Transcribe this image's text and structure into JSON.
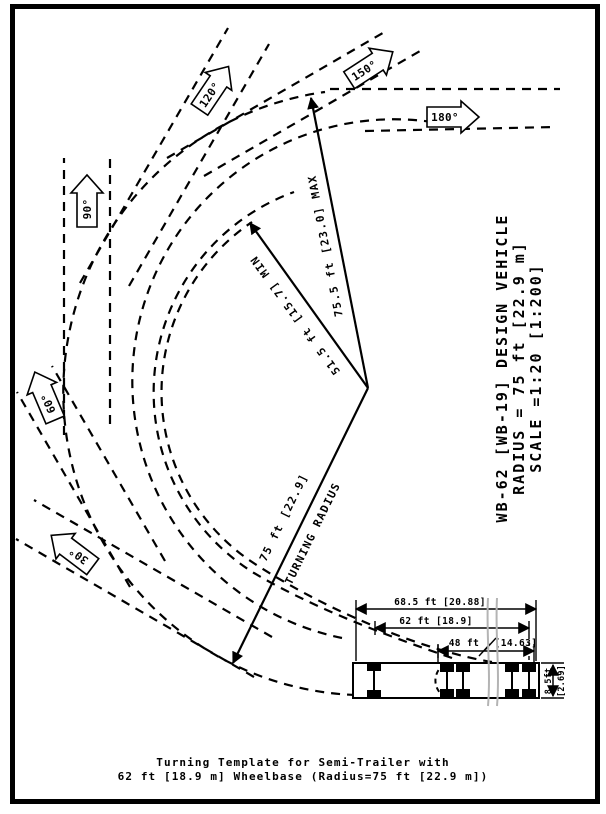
{
  "figure": {
    "caption": {
      "line1": "Turning Template for Semi-Trailer with",
      "line2": "62 ft [18.9 m] Wheelbase (Radius=75 ft [22.9 m])"
    },
    "title_block": {
      "line1": "WB-62 [WB-19] DESIGN VEHICLE",
      "line2": "RADIUS = 75 ft [22.9 m]",
      "line3": "SCALE =1:20 [1:200]"
    },
    "radius_annotations": {
      "turning_radius_value": "75 ft [22.9]",
      "turning_radius_label": "TURNING RADIUS",
      "min_radius": "51.5 ft [15.7] MIN",
      "max_radius": "75.5 ft [23.0] MAX"
    },
    "angle_markers": [
      {
        "label": "30°"
      },
      {
        "label": "60°"
      },
      {
        "label": "90°"
      },
      {
        "label": "120°"
      },
      {
        "label": "150°"
      },
      {
        "label": "180°"
      }
    ],
    "vehicle_dimensions": {
      "overall_length": "68.5 ft [20.88]",
      "wheelbase": "62 ft [18.9]",
      "kingpin_to_axle_ft": "48 ft",
      "kingpin_to_axle_m": "[14.63]",
      "width_ft": "8.5ft",
      "width_m": "[2.69]"
    },
    "colors": {
      "ink": "#000000",
      "paper": "#ffffff",
      "break_line": "#b4b4b4"
    }
  }
}
